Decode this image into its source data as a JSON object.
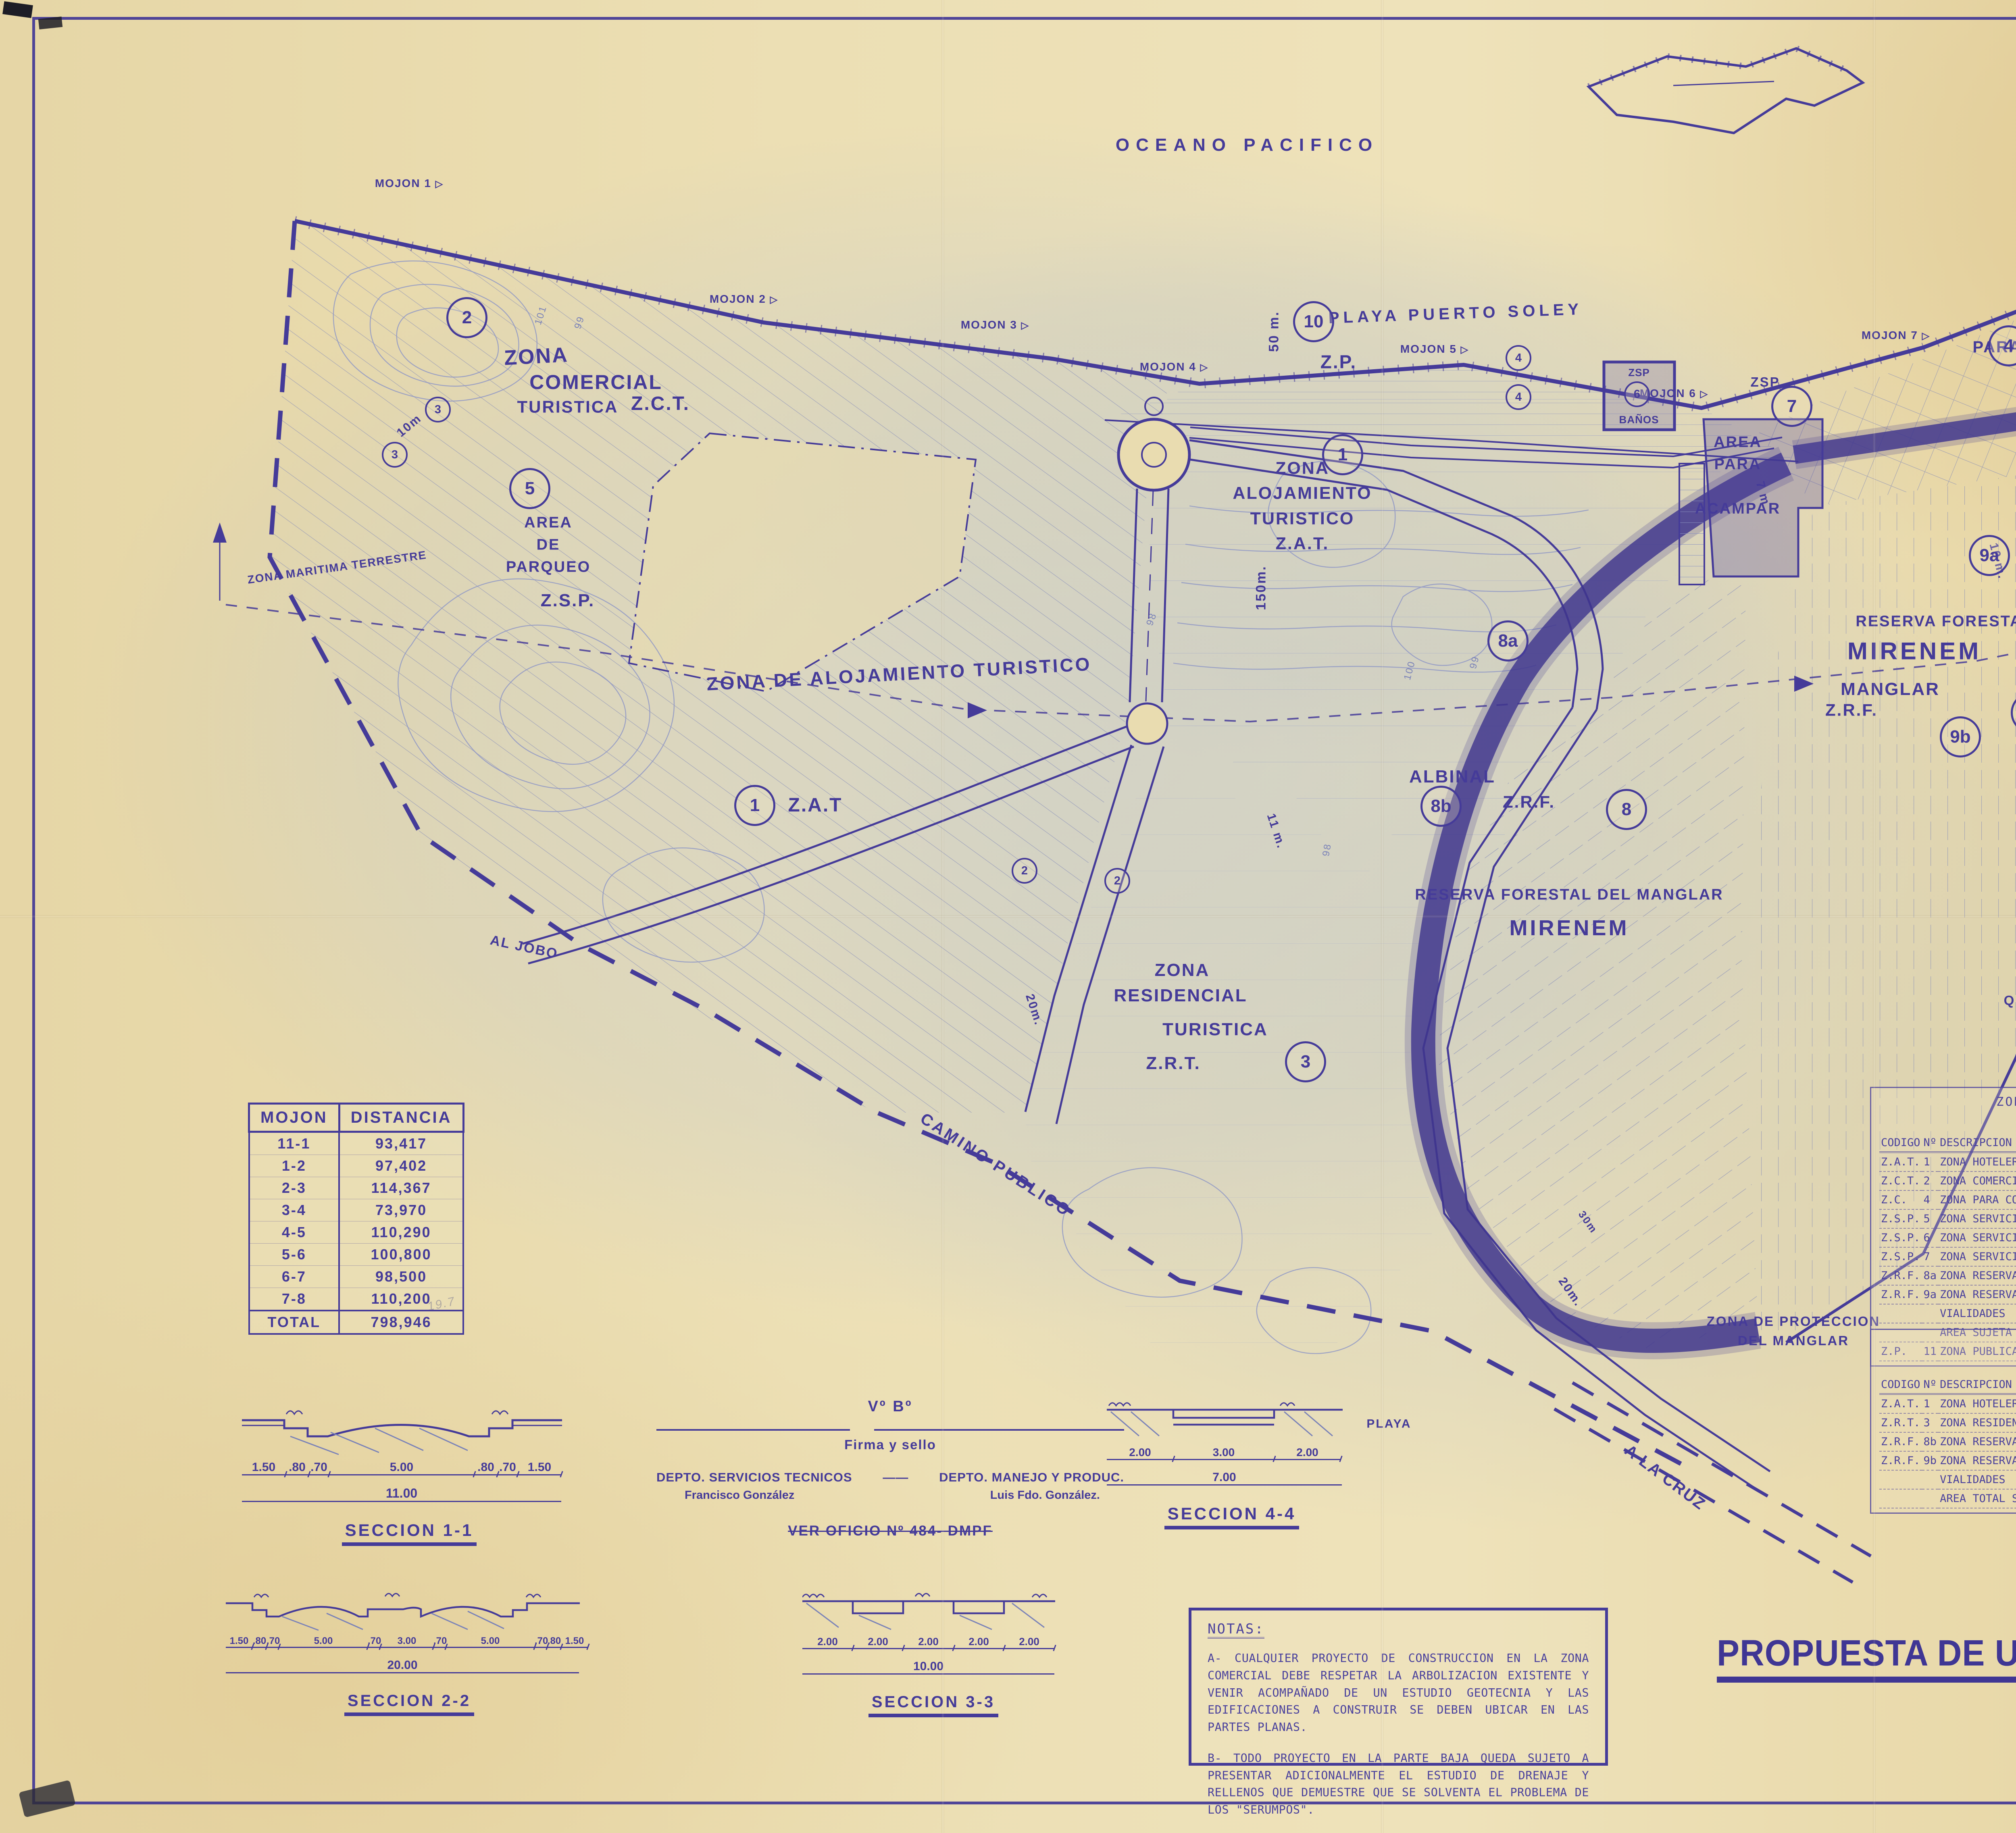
{
  "map": {
    "ocean": "OCEANO PACIFICO",
    "beach": "PLAYA PUERTO SOLEY",
    "zp": "Z.P.",
    "zmt_left": "ZONA MARITIMA TERRESTRE",
    "zmt_right": "ZONA\nMARITIMA\nTERRESTRE",
    "quebrada": "QUEBRADA  DE  AGUA  S.A.",
    "camino": "CAMINO  PUBLICO",
    "al_jobo": "AL  JOBO",
    "a_la_cruz": "A  LA  CRUZ",
    "pencil": "19.7",
    "zones": {
      "comercial_1": "ZONA",
      "comercial_2": "COMERCIAL",
      "comercial_3": "TURISTICA",
      "zct": "Z.C.T.",
      "parqueo": "AREA\nDE\nPARQUEO",
      "zsp": "Z.S.P.",
      "zsp_small": "ZSP.",
      "zsp_box": "ZSP",
      "banos": "BAÑOS",
      "acampar": "AREA\nPARA\n\nACAMPAR",
      "cooperativas": "ZONA\nPARA COOPERATIVAS",
      "zat_center": "ZONA\nALOJAMIENTO\nTURISTICO\nZ.A.T.",
      "zat_left": "ZONA DE  ALOJAMIENTO      TURISTICO",
      "zat_code": "Z.A.T",
      "residencial_1": "ZONA",
      "residencial_2": "RESIDENCIAL",
      "residencial_3": "TURISTICA",
      "zrt": "Z.R.T.",
      "albinal": "ALBINAL",
      "zrf": "Z.R.F.",
      "reserva_manglar": "RESERVA  FORESTAL  DEL  MANGLAR",
      "mirenem": "MIRENEM",
      "manglar": "MANGLAR",
      "zona_reserva": "ZONA DE RESERVA FORESTAL\nDEL MANGLAR",
      "prot_manglar": "ZONA DE PROTECCION\nDEL MANGLAR",
      "prot_manglar_right": "ZONA DE.PROTECCION\nDEL MANGLAR"
    },
    "mojones": {
      "m1": "MOJON 1",
      "m2": "MOJON 2",
      "m3": "MOJON 3",
      "m4": "MOJON 4",
      "m5": "MOJON 5",
      "m6": "MOJON 6",
      "m7": "MOJON 7",
      "m8": "MOJON 8"
    },
    "circled": {
      "n1": "1",
      "n2": "2",
      "n3": "3",
      "n4": "4",
      "n5": "5",
      "n6": "6",
      "n7": "7",
      "n8": "8",
      "n8a": "8a",
      "n8b": "8b",
      "n9": "9",
      "n9a": "9a",
      "n9b": "9b",
      "n10": "10"
    },
    "dims": {
      "d50": "50 m.",
      "d150": "150m.",
      "d20": "20m.",
      "d30": "30m",
      "d11": "11 m.",
      "d10": "10 m.",
      "d7": "7 m",
      "d10b": "10m"
    },
    "contours": {
      "c100": "100",
      "c101": "101",
      "c99": "99",
      "c98": "98"
    }
  },
  "mojon_table": {
    "headers": [
      "MOJON",
      "DISTANCIA"
    ],
    "rows": [
      [
        "11-1",
        "93,417"
      ],
      [
        "1-2",
        "97,402"
      ],
      [
        "2-3",
        "114,367"
      ],
      [
        "3-4",
        "73,970"
      ],
      [
        "4-5",
        "110,290"
      ],
      [
        "5-6",
        "100,800"
      ],
      [
        "6-7",
        "98,500"
      ],
      [
        "7-8",
        "110,200"
      ]
    ],
    "total_row": [
      "TOTAL",
      "798,946"
    ]
  },
  "zmt_table": {
    "title": "ZONA MARITIMO TERRESTRE\nRESUMEN DE AREAS",
    "headers": [
      "CODIGO",
      "Nº",
      "DESCRIPCION",
      "AREA(HAS)",
      "%"
    ],
    "rows": [
      [
        "Z.A.T.",
        "1",
        "ZONA HOTELERA",
        "5.25",
        "44.45"
      ],
      [
        "Z.C.T.",
        "2",
        "ZONA COMERCIAL TURISTICA",
        "0.88",
        "7.45"
      ],
      [
        "Z.C.",
        "4",
        "ZONA PARA COOPERATIVAS",
        "0.90",
        "7.62"
      ],
      [
        "Z.S.P.",
        "5",
        "ZONA SERVICIOS PUBLICOS (PARQUEOS)",
        "0.35",
        "2.96"
      ],
      [
        "Z.S.P.",
        "6",
        "ZONA SERVICIOS PUBLICOS (BAÑOS)",
        "0.05",
        "0.42"
      ],
      [
        "Z.S.P.",
        "7",
        "ZONA SERVICIOS PUBLICOS (AREA ACAMPAR)",
        "0.20",
        "1.69"
      ],
      [
        "Z.R.F.",
        "8a",
        "ZONA RESERVA FORESTAL (REGULADO POR MIRENEM)",
        "2.17",
        "18.37"
      ],
      [
        "Z.R.F.",
        "9a",
        "ZONA RESERVA FORESTAL (A CEDER A MIRENEM)",
        "1.41",
        "11.94"
      ],
      [
        "",
        "",
        "VIALIDADES",
        "0.60",
        "5.08"
      ],
      [
        "",
        "",
        "AREA SUJETA A PLAN REGULADOR",
        "11.81",
        "100.00"
      ],
      [
        "Z.P.",
        "11",
        "ZONA PUBLICA (FAJA INALIENABLE)",
        "3.99",
        ""
      ]
    ]
  },
  "private_table": {
    "title": "ZONA PRIVADA\nRESUMEN DE AREAS",
    "headers": [
      "CODIGO",
      "Nº",
      "DESCRIPCION",
      "AREA(HAS)",
      "%"
    ],
    "rows": [
      [
        "Z.A.T.",
        "1",
        "ZONA HOTELERA",
        "3.08",
        "24.44"
      ],
      [
        "Z.R.T.",
        "3",
        "ZONA RESIDENCIAL",
        "3.90",
        "30.95"
      ],
      [
        "Z.R.F.",
        "8b",
        "ZONA RESERVA FORESTAL (REGULADO POR MIRENEM)",
        "4.49",
        "35.63"
      ],
      [
        "Z.R.F.",
        "9b",
        "ZONA RESERVA FORESTAL (A CEDER A MIRENEM)",
        "0.73",
        "5.79"
      ],
      [
        "",
        "",
        "VIALIDADES",
        "0.40",
        "3.17"
      ],
      [
        "",
        "",
        "AREA TOTAL SUJETA A PLAN REGULADOR",
        "12.60",
        "100.00"
      ]
    ]
  },
  "notes": {
    "heading": "NOTAS:",
    "note_a": "A- CUALQUIER PROYECTO DE CONSTRUCCION EN LA ZONA COMERCIAL DEBE RESPETAR LA ARBOLIZACION EXISTENTE Y VENIR ACOMPAÑADO DE UN ESTUDIO GEOTECNIA Y LAS EDIFICACIONES A CONSTRUIR SE DEBEN UBICAR EN LAS PARTES PLANAS.",
    "note_b": "B- TODO PROYECTO EN LA PARTE BAJA QUEDA SUJETO A PRESENTAR ADICIONALMENTE EL ESTUDIO DE DRENAJE Y RELLENOS QUE DEMUESTRE QUE SE SOLVENTA EL PROBLEMA DE LOS \"SERUMPOS\"."
  },
  "sections": {
    "s11": {
      "label": "SECCION 1-1",
      "dims": [
        "1.50",
        ".80",
        ".70",
        "5.00",
        ".80",
        ".70",
        "1.50"
      ],
      "total": "11.00"
    },
    "s22": {
      "label": "SECCION 2-2",
      "dims": [
        "1.50",
        ".80",
        ".70",
        "5.00",
        ".70",
        "3.00",
        ".70",
        "5.00",
        ".70",
        ".80",
        "1.50"
      ],
      "total": "20.00"
    },
    "s33": {
      "label": "SECCION 3-3",
      "dims": [
        "2.00",
        "2.00",
        "2.00",
        "2.00",
        "2.00"
      ],
      "total": "10.00"
    },
    "s44": {
      "label": "SECCION 4-4",
      "dims": [
        "2.00",
        "3.00",
        "2.00"
      ],
      "total": "7.00",
      "playa": "PLAYA"
    }
  },
  "approval": {
    "vb": "Vº Bº",
    "firma": "Firma y sello",
    "dept_left": "DEPTO. SERVICIOS  TECNICOS",
    "dept_right": "DEPTO. MANEJO  Y  PRODUC.",
    "name_left": "Francisco   González",
    "name_right": "Luis  Fdo.  González.",
    "oficio": "VER  OFICIO  Nº 484- DMPF"
  },
  "main_title": "PROPUESTA DE USO DEL SUELO, Y VIALIDADES",
  "stamp": {
    "ring": "PLANEAMIENTO Y DESARROLLO •",
    "center": "I.C.T."
  },
  "titleblock": {
    "rev_headers": [
      "N°",
      "FECHA",
      "DESCRIPCION",
      "POR"
    ],
    "rev_caption": "REVISIONES",
    "proyecto_label": "PROYECTO",
    "proyecto": "PLAN  REGULADOR",
    "propietario_label": "PROPIETARIO",
    "propietario": "RANCHO  EL  DIAMANTE",
    "propietario_sa": "S.A.",
    "provincia_label": "PROVINCIA",
    "provincia": "GUANACASTE",
    "canton_label": "CANTON",
    "canton": "LA  CRUZ",
    "distrito_label": "DISTRITO",
    "distrito": "1ª LA  CRUZ",
    "logo_text": "COMERCIO &\nDESARROLLO SA.",
    "unidad_label": "UNIDAD",
    "contenido_label": "CONTENIDO",
    "contenido": "PROPUESTA  DE  USO  DEL  SUELO.\nVIALIDADES",
    "arquitectura_label": "ARQUITECTURA",
    "civil_label": "ING. CIVIL / ESTRUCTURAL",
    "electrica_label": "ING. ELECTRICA / MECANICA",
    "soley": "SOLEY",
    "prof_label": "PROFESIONAL  RESPONSABLE",
    "prof_name": "ING. RICARDO TINOCO D.",
    "prof_num_label": "N°",
    "prof_num": "IC-2340",
    "dibujo_label": "DIBUJO",
    "dibujo": "L.A. CASTILLO V.",
    "escala_label": "ESCALA",
    "escala": "1:1000",
    "fecha_label": "FECHA",
    "fecha": "MAYO 1991",
    "superviso_label": "SUPERVISO",
    "superviso": "RICARDO  MATA  M.",
    "reviso_label": "REVISO",
    "reviso": "RICARDO  TINOCO  D.",
    "plano_nota": "PLANO ORIGINAL PROPIEDAD DE COMERCIO Y DESARROLLO S.A. PROHIBIDO SU USO PARCIAL O TOTAL SIN AUTORIZACION ESCRITA",
    "aprobo_label": "APROBO",
    "aprobo": "R. TINOCO D.",
    "por_obra_label": "N° POR OBRA",
    "por_obra": "5",
    "consecutivo_label": "N°CONSECUTIVO",
    "especialidad_label": "N° ESPECIALIDAD",
    "de_label": "DE",
    "de_total": "5"
  }
}
